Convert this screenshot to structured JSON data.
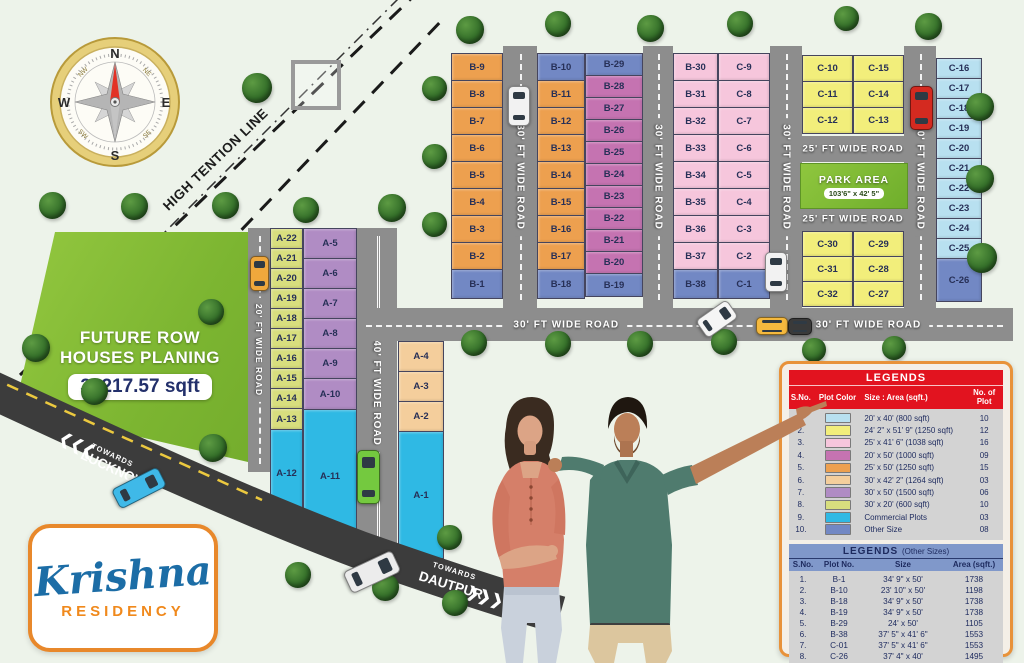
{
  "palette": {
    "lightblue": "#b8e0f0",
    "yellow": "#f2ee7b",
    "pink": "#f6c6dc",
    "magenta": "#c573b1",
    "orange": "#eda04f",
    "peach": "#f4ce9c",
    "purple": "#b08cc4",
    "yellowgreen": "#d8de7e",
    "cyan": "#2fb9e4",
    "blue": "#7288c4"
  },
  "compass": {
    "n": "N",
    "e": "E",
    "s": "S",
    "w": "W",
    "nw": "NW",
    "ne": "NE",
    "sw": "SW",
    "se": "SE"
  },
  "high_tension_label": "HIGH TENTION LINE",
  "future_area": {
    "line1": "FUTURE ROW",
    "line2": "HOUSES PLANING",
    "area": "39217.57 sqft"
  },
  "park": {
    "title": "PARK AREA",
    "size": "103'6\" x 42' 5\""
  },
  "roads": {
    "r20": "20' FT WIDE ROAD",
    "r25": "25' FT WIDE ROAD",
    "r30": "30' FT WIDE ROAD",
    "r40": "40' FT WIDE ROAD"
  },
  "towards": {
    "lucknow_line1": "TOWARDS",
    "lucknow_line2": "LUCKNOW",
    "dautpur_line1": "TOWARDS",
    "dautpur_line2": "DAUTPUR"
  },
  "icons": {
    "chevrons_left": "❮❮❮",
    "chevrons_right": "❯❯❯"
  },
  "logo": {
    "name": "Krishna",
    "sub": "RESIDENCY"
  },
  "legend": {
    "title": "LEGENDS",
    "headers": [
      "S.No.",
      "Plot Color",
      "Size : Area (sqft.)",
      "No. of Plot"
    ],
    "rows": [
      {
        "sno": "1.",
        "color": "lightblue",
        "size": "20' x 40' (800 sqft)",
        "count": "10"
      },
      {
        "sno": "2.",
        "color": "yellow",
        "size": "24' 2\" x 51' 9\" (1250 sqft)",
        "count": "12"
      },
      {
        "sno": "3.",
        "color": "pink",
        "size": "25' x 41' 6\" (1038 sqft)",
        "count": "16"
      },
      {
        "sno": "4.",
        "color": "magenta",
        "size": "20' x 50' (1000 sqft)",
        "count": "09"
      },
      {
        "sno": "5.",
        "color": "orange",
        "size": "25' x 50' (1250 sqft)",
        "count": "15"
      },
      {
        "sno": "6.",
        "color": "peach",
        "size": "30' x 42' 2\" (1264 sqft)",
        "count": "03"
      },
      {
        "sno": "7.",
        "color": "purple",
        "size": "30' x 50' (1500 sqft)",
        "count": "06"
      },
      {
        "sno": "8.",
        "color": "yellowgreen",
        "size": "30' x 20' (600 sqft)",
        "count": "10"
      },
      {
        "sno": "9.",
        "color": "cyan",
        "size": "Commercial Plots",
        "count": "03"
      },
      {
        "sno": "10.",
        "color": "blue",
        "size": "Other Size",
        "count": "08"
      }
    ]
  },
  "legend_other": {
    "title": "LEGENDS",
    "title_suffix": "(Other Sizes)",
    "headers": [
      "S.No.",
      "Plot No.",
      "Size",
      "Area (sqft.)"
    ],
    "rows": [
      {
        "sno": "1.",
        "plot": "B-1",
        "size": "34' 9\" x 50'",
        "area": "1738"
      },
      {
        "sno": "2.",
        "plot": "B-10",
        "size": "23' 10\" x 50'",
        "area": "1198"
      },
      {
        "sno": "3.",
        "plot": "B-18",
        "size": "34' 9\" x 50'",
        "area": "1738"
      },
      {
        "sno": "4.",
        "plot": "B-19",
        "size": "34' 9\" x 50'",
        "area": "1738"
      },
      {
        "sno": "5.",
        "plot": "B-29",
        "size": "24' x 50'",
        "area": "1105"
      },
      {
        "sno": "6.",
        "plot": "B-38",
        "size": "37' 5\" x 41' 6\"",
        "area": "1553"
      },
      {
        "sno": "7.",
        "plot": "C-01",
        "size": "37' 5\" x 41' 6\"",
        "area": "1553"
      },
      {
        "sno": "8.",
        "plot": "C-26",
        "size": "37' 4\" x 40'",
        "area": "1495"
      }
    ]
  },
  "plot_columns": [
    {
      "name": "a-col-1",
      "x": 270,
      "y": 228,
      "w": 33,
      "cells": [
        [
          "A-22",
          "yellowgreen",
          21
        ],
        [
          "A-21",
          "yellowgreen",
          21
        ],
        [
          "A-20",
          "yellowgreen",
          21
        ],
        [
          "A-19",
          "yellowgreen",
          21
        ],
        [
          "A-18",
          "yellowgreen",
          21
        ],
        [
          "A-17",
          "yellowgreen",
          21
        ],
        [
          "A-16",
          "yellowgreen",
          21
        ],
        [
          "A-15",
          "yellowgreen",
          21
        ],
        [
          "A-14",
          "yellowgreen",
          21
        ],
        [
          "A-13",
          "yellowgreen",
          22
        ],
        [
          "A-12",
          "cyan",
          88
        ]
      ]
    },
    {
      "name": "a-col-2",
      "x": 303,
      "y": 228,
      "w": 54,
      "cells": [
        [
          "A-5",
          "purple",
          31
        ],
        [
          "A-6",
          "purple",
          31
        ],
        [
          "A-7",
          "purple",
          31
        ],
        [
          "A-8",
          "purple",
          31
        ],
        [
          "A-9",
          "purple",
          31
        ],
        [
          "A-10",
          "purple",
          32
        ],
        [
          "A-11",
          "cyan",
          135
        ]
      ]
    },
    {
      "name": "a-col-3",
      "x": 398,
      "y": 341,
      "w": 46,
      "cells": [
        [
          "A-4",
          "peach",
          31
        ],
        [
          "A-3",
          "peach",
          31
        ],
        [
          "A-2",
          "peach",
          31
        ],
        [
          "A-1",
          "cyan",
          128
        ]
      ]
    },
    {
      "name": "b-col-1",
      "x": 451,
      "y": 53,
      "w": 52,
      "cells": [
        [
          "B-9",
          "orange",
          28
        ],
        [
          "B-8",
          "orange",
          28
        ],
        [
          "B-7",
          "orange",
          28
        ],
        [
          "B-6",
          "orange",
          28
        ],
        [
          "B-5",
          "orange",
          28
        ],
        [
          "B-4",
          "orange",
          28
        ],
        [
          "B-3",
          "orange",
          28
        ],
        [
          "B-2",
          "orange",
          28
        ],
        [
          "B-1",
          "blue",
          30
        ]
      ]
    },
    {
      "name": "b-col-2",
      "x": 537,
      "y": 53,
      "w": 48,
      "cells": [
        [
          "B-10",
          "blue",
          28
        ],
        [
          "B-11",
          "orange",
          28
        ],
        [
          "B-12",
          "orange",
          28
        ],
        [
          "B-13",
          "orange",
          28
        ],
        [
          "B-14",
          "orange",
          28
        ],
        [
          "B-15",
          "orange",
          28
        ],
        [
          "B-16",
          "orange",
          28
        ],
        [
          "B-17",
          "orange",
          28
        ],
        [
          "B-18",
          "blue",
          30
        ]
      ]
    },
    {
      "name": "b-col-3",
      "x": 585,
      "y": 53,
      "w": 58,
      "cells": [
        [
          "B-29",
          "blue",
          23
        ],
        [
          "B-28",
          "magenta",
          23
        ],
        [
          "B-27",
          "magenta",
          23
        ],
        [
          "B-26",
          "magenta",
          23
        ],
        [
          "B-25",
          "magenta",
          23
        ],
        [
          "B-24",
          "magenta",
          23
        ],
        [
          "B-23",
          "magenta",
          23
        ],
        [
          "B-22",
          "magenta",
          23
        ],
        [
          "B-21",
          "magenta",
          23
        ],
        [
          "B-20",
          "magenta",
          23
        ],
        [
          "B-19",
          "blue",
          24
        ]
      ]
    },
    {
      "name": "b-col-4",
      "x": 673,
      "y": 53,
      "w": 45,
      "cells": [
        [
          "B-30",
          "pink",
          28
        ],
        [
          "B-31",
          "pink",
          28
        ],
        [
          "B-32",
          "pink",
          28
        ],
        [
          "B-33",
          "pink",
          28
        ],
        [
          "B-34",
          "pink",
          28
        ],
        [
          "B-35",
          "pink",
          28
        ],
        [
          "B-36",
          "pink",
          28
        ],
        [
          "B-37",
          "pink",
          28
        ],
        [
          "B-38",
          "blue",
          30
        ]
      ]
    },
    {
      "name": "b-col-5",
      "x": 718,
      "y": 53,
      "w": 52,
      "cells": [
        [
          "C-9",
          "pink",
          28
        ],
        [
          "C-8",
          "pink",
          28
        ],
        [
          "C-7",
          "pink",
          28
        ],
        [
          "C-6",
          "pink",
          28
        ],
        [
          "C-5",
          "pink",
          28
        ],
        [
          "C-4",
          "pink",
          28
        ],
        [
          "C-3",
          "pink",
          28
        ],
        [
          "C-2",
          "pink",
          28
        ],
        [
          "C-1",
          "blue",
          30
        ]
      ]
    },
    {
      "name": "c-yellow-top-left",
      "x": 802,
      "y": 55,
      "w": 51,
      "cells": [
        [
          "C-10",
          "yellow",
          27
        ],
        [
          "C-11",
          "yellow",
          27
        ],
        [
          "C-12",
          "yellow",
          27
        ]
      ]
    },
    {
      "name": "c-yellow-top-right",
      "x": 853,
      "y": 55,
      "w": 51,
      "cells": [
        [
          "C-15",
          "yellow",
          27
        ],
        [
          "C-14",
          "yellow",
          27
        ],
        [
          "C-13",
          "yellow",
          27
        ]
      ]
    },
    {
      "name": "c-yellow-bottom-left",
      "x": 802,
      "y": 231,
      "w": 51,
      "cells": [
        [
          "C-30",
          "yellow",
          26
        ],
        [
          "C-31",
          "yellow",
          26
        ],
        [
          "C-32",
          "yellow",
          26
        ]
      ]
    },
    {
      "name": "c-yellow-bottom-right",
      "x": 853,
      "y": 231,
      "w": 51,
      "cells": [
        [
          "C-29",
          "yellow",
          26
        ],
        [
          "C-28",
          "yellow",
          26
        ],
        [
          "C-27",
          "yellow",
          26
        ]
      ]
    },
    {
      "name": "c-col-right",
      "x": 936,
      "y": 58,
      "w": 46,
      "cells": [
        [
          "C-16",
          "lightblue",
          21
        ],
        [
          "C-17",
          "lightblue",
          21
        ],
        [
          "C-18",
          "lightblue",
          21
        ],
        [
          "C-19",
          "lightblue",
          21
        ],
        [
          "C-20",
          "lightblue",
          21
        ],
        [
          "C-21",
          "lightblue",
          21
        ],
        [
          "C-22",
          "lightblue",
          21
        ],
        [
          "C-23",
          "lightblue",
          21
        ],
        [
          "C-24",
          "lightblue",
          21
        ],
        [
          "C-25",
          "lightblue",
          21
        ],
        [
          "C-26",
          "blue",
          44
        ]
      ]
    }
  ],
  "decor": {
    "trees": [
      [
        470,
        30,
        28
      ],
      [
        558,
        24,
        26
      ],
      [
        650,
        28,
        27
      ],
      [
        740,
        24,
        26
      ],
      [
        846,
        18,
        25
      ],
      [
        928,
        26,
        27
      ],
      [
        980,
        107,
        28
      ],
      [
        980,
        179,
        28
      ],
      [
        982,
        258,
        30
      ],
      [
        434,
        88,
        25
      ],
      [
        434,
        156,
        25
      ],
      [
        434,
        224,
        25
      ],
      [
        474,
        343,
        26
      ],
      [
        558,
        344,
        26
      ],
      [
        640,
        344,
        26
      ],
      [
        724,
        342,
        26
      ],
      [
        814,
        350,
        24
      ],
      [
        894,
        348,
        24
      ],
      [
        52,
        205,
        27
      ],
      [
        134,
        206,
        27
      ],
      [
        225,
        205,
        27
      ],
      [
        257,
        88,
        30
      ],
      [
        306,
        210,
        26
      ],
      [
        392,
        208,
        28
      ],
      [
        36,
        348,
        28
      ],
      [
        94,
        391,
        27
      ],
      [
        211,
        312,
        26
      ],
      [
        213,
        448,
        28
      ],
      [
        298,
        575,
        26
      ],
      [
        385,
        587,
        27
      ],
      [
        449,
        537,
        25
      ],
      [
        455,
        603,
        26
      ]
    ],
    "vehicles": [
      {
        "name": "white-car",
        "color": "#f2f2f2",
        "x": 508,
        "y": 86,
        "w": 20,
        "h": 38,
        "rot": 0
      },
      {
        "name": "white-car",
        "color": "#f2f2f2",
        "x": 765,
        "y": 252,
        "w": 20,
        "h": 38,
        "rot": 0
      },
      {
        "name": "white-car-tilted",
        "color": "#f5f5f5",
        "x": 706,
        "y": 300,
        "w": 20,
        "h": 36,
        "rot": 55
      },
      {
        "name": "red-car",
        "color": "#d42a20",
        "x": 910,
        "y": 86,
        "w": 21,
        "h": 42,
        "rot": 0
      },
      {
        "name": "orange-truck",
        "color": "#f0a83c",
        "x": 250,
        "y": 256,
        "w": 17,
        "h": 33,
        "rot": 0
      },
      {
        "name": "yellow-truck",
        "color": "#f5b93e",
        "x": 756,
        "y": 317,
        "w": 30,
        "h": 16,
        "rot": 0
      },
      {
        "name": "dark-truck",
        "color": "#3a3a3a",
        "x": 788,
        "y": 318,
        "w": 22,
        "h": 15,
        "rot": 0
      },
      {
        "name": "green-bus",
        "color": "#74c93f",
        "x": 357,
        "y": 450,
        "w": 21,
        "h": 52,
        "rot": 0
      },
      {
        "name": "blue-bus",
        "color": "#3fb9e8",
        "x": 128,
        "y": 462,
        "w": 20,
        "h": 50,
        "rot": 63
      },
      {
        "name": "white-truck",
        "color": "#ececec",
        "x": 360,
        "y": 545,
        "w": 22,
        "h": 52,
        "rot": 65
      }
    ]
  }
}
